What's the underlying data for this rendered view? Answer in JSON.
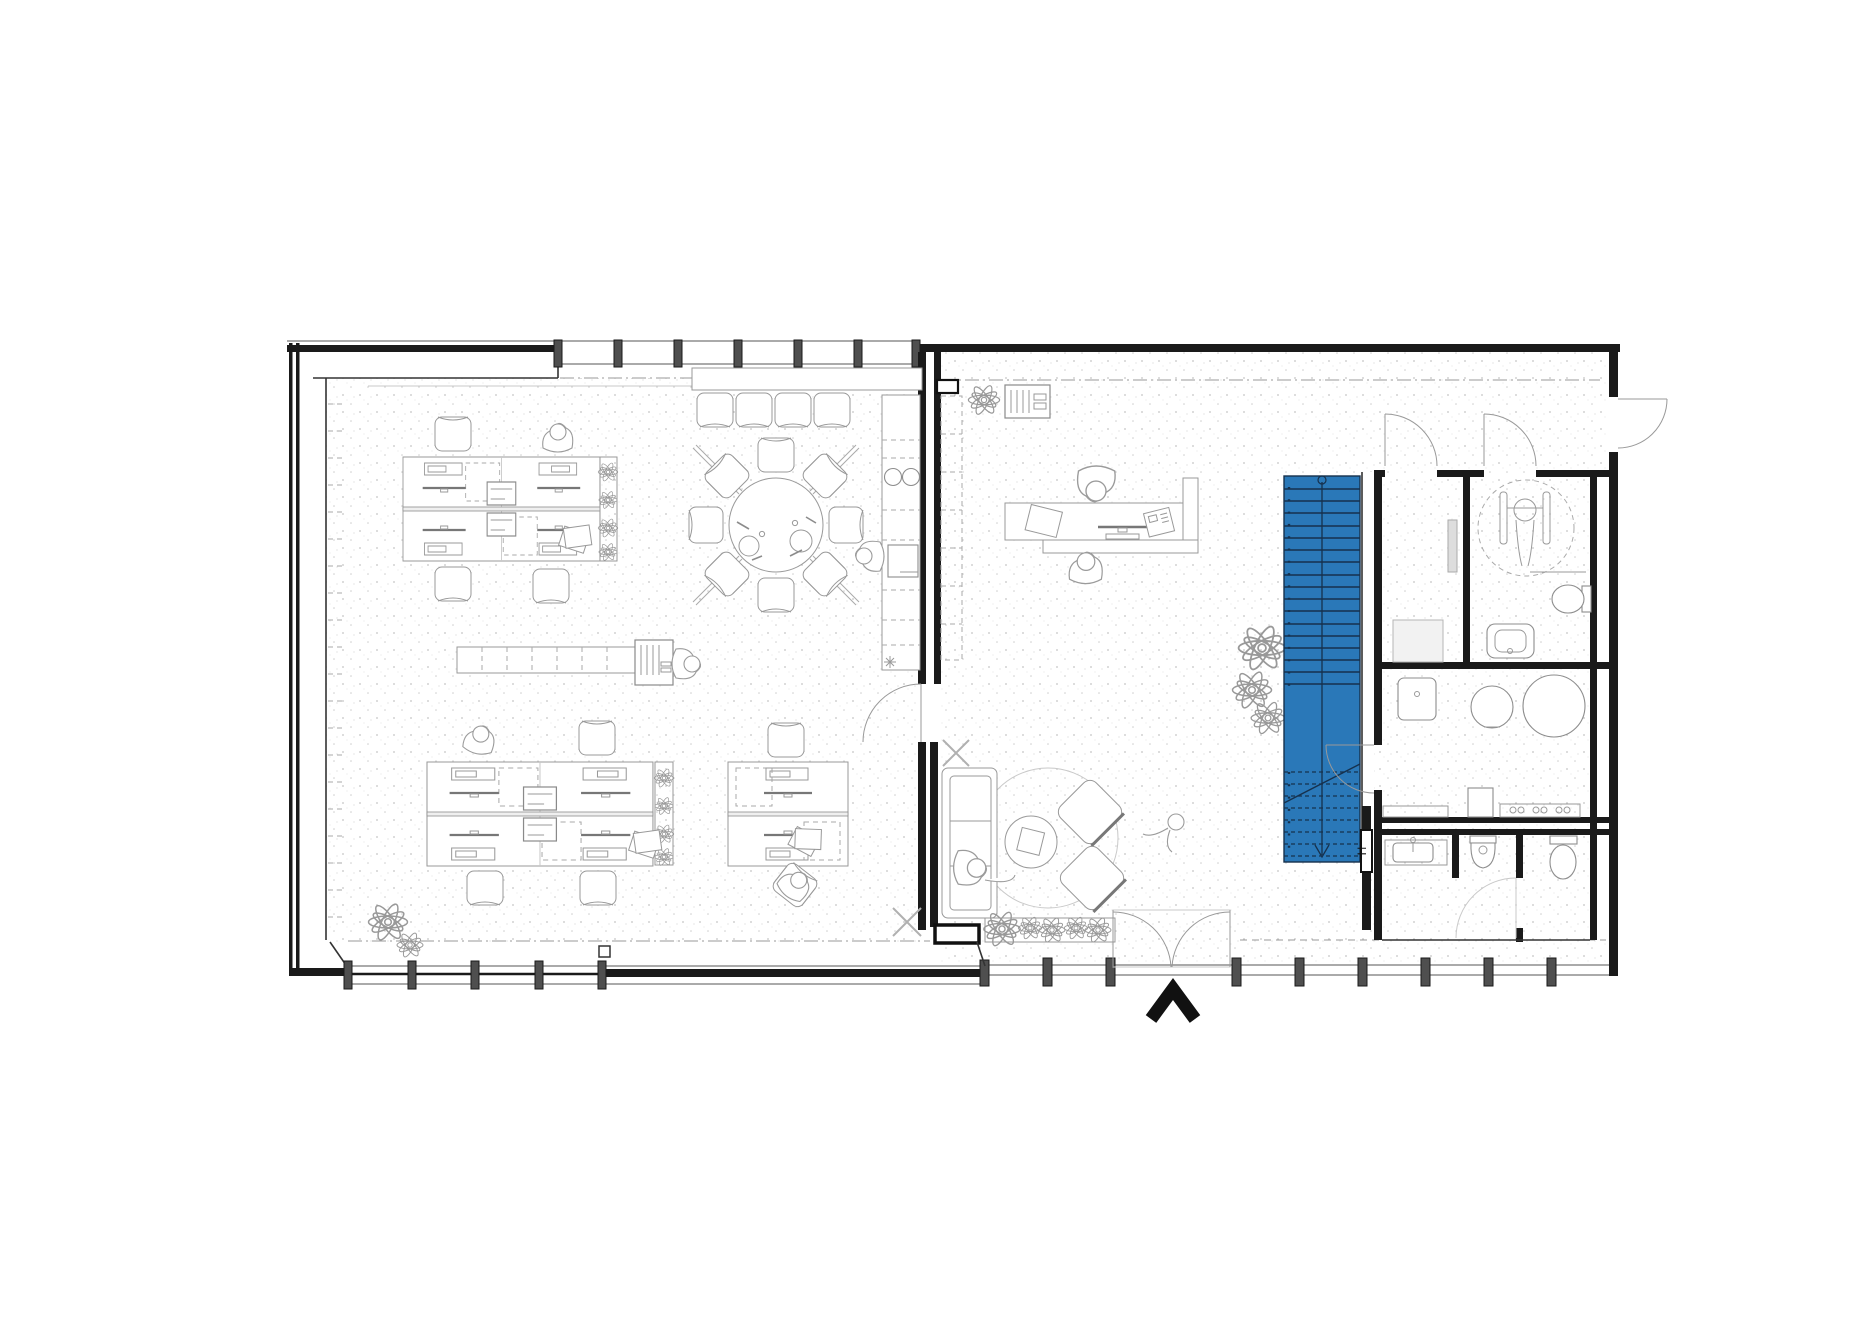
{
  "drawing": {
    "type": "architectural-floor-plan",
    "labels": {
      "stair_door": "H"
    },
    "colors": {
      "background": "#ffffff",
      "wall": "#1a1a1a",
      "mullion": "#4f4f4f",
      "furniture_line": "#999999",
      "stipple_dot": "#c4c4c4",
      "stair_fill": "#2a78b8",
      "stair_tread_line": "#16314d",
      "north_arrow": "#111111"
    },
    "elements": [
      "open-office-left-zone",
      "entry-lobby-right-zone",
      "workstation-cluster-top",
      "workstation-cluster-bottom-left",
      "workstation-cluster-bottom-right",
      "round-meeting-table",
      "stacked-chair-row",
      "window-console",
      "kitchenette-counter",
      "sideboard-row",
      "printer-station",
      "reception-desk",
      "staircase-blue",
      "sanitary-block",
      "shower-room",
      "accessible-wc",
      "utility-room",
      "mens-wc",
      "lounge-sofa",
      "lounge-armchairs",
      "round-rug",
      "coffee-table",
      "entrance-double-door",
      "exterior-side-door",
      "north-arrow",
      "planter-box",
      "plants",
      "persons"
    ]
  }
}
